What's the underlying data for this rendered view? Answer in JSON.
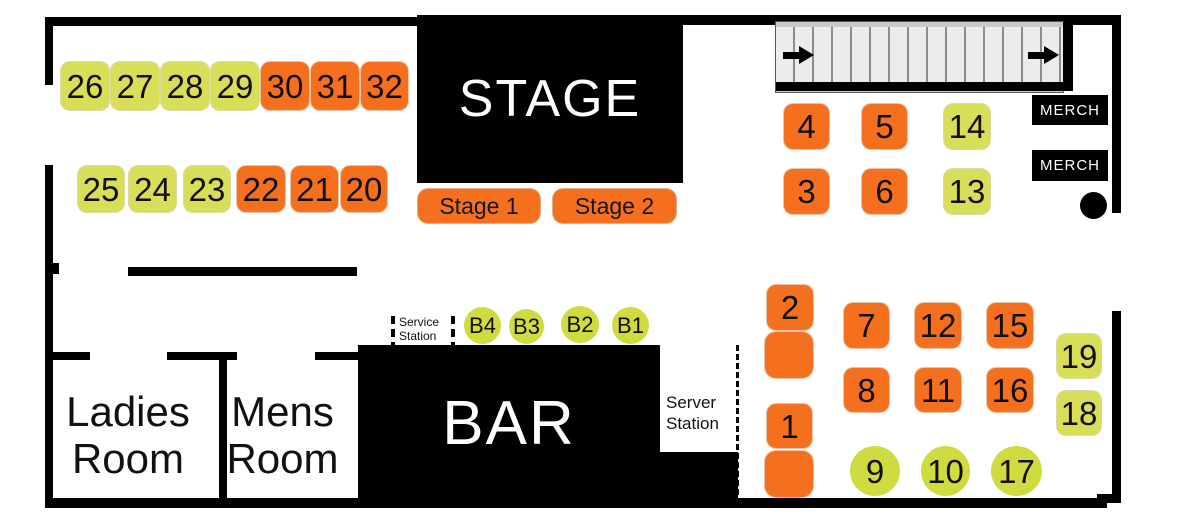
{
  "colors": {
    "table_orange": "#F5701E",
    "table_green_square": "#D8DE58",
    "table_green_circle": "#CFDB3F",
    "structure_black": "#000000"
  },
  "stage": {
    "title": "STAGE",
    "stage1_label": "Stage 1",
    "stage2_label": "Stage 2"
  },
  "bar": {
    "title": "BAR"
  },
  "rooms": {
    "ladies": "Ladies Room",
    "mens": "Mens Room"
  },
  "stations": {
    "service": "Service Station",
    "server": "Server Station"
  },
  "merch": {
    "labels": [
      "MERCH",
      "MERCH"
    ]
  },
  "icons": {
    "stairs_arrows": "arrow-right",
    "merch_dot": "black-dot-marker"
  },
  "tables": [
    {
      "label": "26",
      "kind": "green",
      "x": 61,
      "y": 62,
      "w": 48,
      "h": 48
    },
    {
      "label": "27",
      "kind": "green",
      "x": 111,
      "y": 62,
      "w": 48,
      "h": 48
    },
    {
      "label": "28",
      "kind": "green",
      "x": 161,
      "y": 62,
      "w": 48,
      "h": 48
    },
    {
      "label": "29",
      "kind": "green",
      "x": 211,
      "y": 62,
      "w": 48,
      "h": 48
    },
    {
      "label": "30",
      "kind": "orange",
      "x": 261,
      "y": 62,
      "w": 48,
      "h": 48
    },
    {
      "label": "31",
      "kind": "orange",
      "x": 311,
      "y": 62,
      "w": 48,
      "h": 48
    },
    {
      "label": "32",
      "kind": "orange",
      "x": 361,
      "y": 62,
      "w": 47,
      "h": 48
    },
    {
      "label": "25",
      "kind": "green",
      "x": 78,
      "y": 166,
      "w": 46,
      "h": 46
    },
    {
      "label": "24",
      "kind": "green",
      "x": 129,
      "y": 166,
      "w": 47,
      "h": 46
    },
    {
      "label": "23",
      "kind": "green",
      "x": 184,
      "y": 166,
      "w": 46,
      "h": 46
    },
    {
      "label": "22",
      "kind": "orange",
      "x": 237,
      "y": 166,
      "w": 48,
      "h": 46
    },
    {
      "label": "21",
      "kind": "orange",
      "x": 291,
      "y": 166,
      "w": 47,
      "h": 46
    },
    {
      "label": "20",
      "kind": "orange",
      "x": 341,
      "y": 166,
      "w": 46,
      "h": 46
    },
    {
      "label": "4",
      "kind": "orange",
      "x": 784,
      "y": 104,
      "w": 45,
      "h": 45
    },
    {
      "label": "5",
      "kind": "orange",
      "x": 862,
      "y": 104,
      "w": 45,
      "h": 45
    },
    {
      "label": "14",
      "kind": "green",
      "x": 944,
      "y": 104,
      "w": 46,
      "h": 45
    },
    {
      "label": "3",
      "kind": "orange",
      "x": 784,
      "y": 169,
      "w": 45,
      "h": 45
    },
    {
      "label": "6",
      "kind": "orange",
      "x": 862,
      "y": 169,
      "w": 45,
      "h": 45
    },
    {
      "label": "13",
      "kind": "green",
      "x": 944,
      "y": 169,
      "w": 46,
      "h": 45
    },
    {
      "label": "2",
      "kind": "orange",
      "x": 767,
      "y": 285,
      "w": 46,
      "h": 45
    },
    {
      "label": "",
      "kind": "orange seat",
      "x": 765,
      "y": 332,
      "w": 48,
      "h": 46
    },
    {
      "label": "7",
      "kind": "orange",
      "x": 844,
      "y": 303,
      "w": 45,
      "h": 45
    },
    {
      "label": "12",
      "kind": "orange",
      "x": 915,
      "y": 303,
      "w": 46,
      "h": 45
    },
    {
      "label": "15",
      "kind": "orange",
      "x": 987,
      "y": 303,
      "w": 46,
      "h": 45
    },
    {
      "label": "8",
      "kind": "orange",
      "x": 844,
      "y": 368,
      "w": 45,
      "h": 44
    },
    {
      "label": "11",
      "kind": "orange",
      "x": 915,
      "y": 368,
      "w": 46,
      "h": 44
    },
    {
      "label": "16",
      "kind": "orange",
      "x": 987,
      "y": 368,
      "w": 46,
      "h": 44
    },
    {
      "label": "19",
      "kind": "green",
      "x": 1057,
      "y": 334,
      "w": 44,
      "h": 44
    },
    {
      "label": "18",
      "kind": "green",
      "x": 1057,
      "y": 391,
      "w": 44,
      "h": 44
    },
    {
      "label": "1",
      "kind": "orange",
      "x": 767,
      "y": 404,
      "w": 45,
      "h": 44
    },
    {
      "label": "",
      "kind": "orange seat",
      "x": 765,
      "y": 451,
      "w": 48,
      "h": 46
    },
    {
      "label": "9",
      "kind": "circle",
      "x": 850,
      "y": 446,
      "w": 50,
      "h": 50
    },
    {
      "label": "10",
      "kind": "circle",
      "x": 921,
      "y": 446,
      "w": 49,
      "h": 50
    },
    {
      "label": "17",
      "kind": "circle",
      "x": 991,
      "y": 446,
      "w": 51,
      "h": 50
    },
    {
      "label": "B4",
      "kind": "circle bseat",
      "x": 464,
      "y": 307,
      "w": 37,
      "h": 37
    },
    {
      "label": "B3",
      "kind": "circle bseat",
      "x": 509,
      "y": 309,
      "w": 35,
      "h": 35
    },
    {
      "label": "B2",
      "kind": "circle bseat",
      "x": 561,
      "y": 306,
      "w": 38,
      "h": 37
    },
    {
      "label": "B1",
      "kind": "circle bseat",
      "x": 612,
      "y": 307,
      "w": 37,
      "h": 37
    }
  ]
}
